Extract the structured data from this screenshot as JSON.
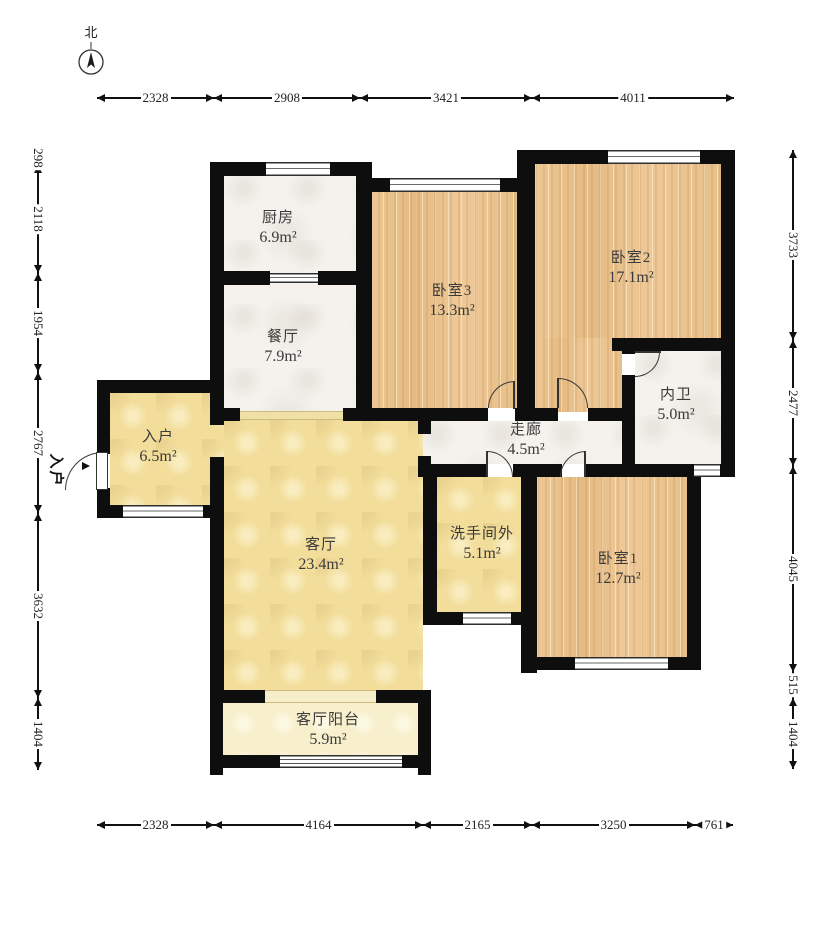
{
  "compass": {
    "label": "北"
  },
  "entry_marker": {
    "label": "入户"
  },
  "rooms": {
    "kitchen": {
      "name": "厨房",
      "area": "6.9m²"
    },
    "dining": {
      "name": "餐厅",
      "area": "7.9m²"
    },
    "bedroom3": {
      "name": "卧室3",
      "area": "13.3m²"
    },
    "bedroom2": {
      "name": "卧室2",
      "area": "17.1m²"
    },
    "inner_bath": {
      "name": "内卫",
      "area": "5.0m²"
    },
    "corridor": {
      "name": "走廊",
      "area": "4.5m²"
    },
    "entry": {
      "name": "入户",
      "area": "6.5m²"
    },
    "living": {
      "name": "客厅",
      "area": "23.4m²"
    },
    "washroom": {
      "name": "洗手间外",
      "area": "5.1m²"
    },
    "bedroom1": {
      "name": "卧室1",
      "area": "12.7m²"
    },
    "balcony": {
      "name": "客厅阳台",
      "area": "5.9m²"
    }
  },
  "dimensions": [
    {
      "name": "top",
      "dir": "h",
      "pos": 98,
      "from": 97,
      "segments": [
        {
          "to": 214,
          "label": "2328"
        },
        {
          "to": 360,
          "label": "2908"
        },
        {
          "to": 532,
          "label": "3421"
        },
        {
          "to": 734,
          "label": "4011"
        }
      ]
    },
    {
      "name": "bottom",
      "dir": "h",
      "pos": 825,
      "from": 97,
      "segments": [
        {
          "to": 214,
          "label": "2328"
        },
        {
          "to": 423,
          "label": "4164"
        },
        {
          "to": 532,
          "label": "2165"
        },
        {
          "to": 695,
          "label": "3250"
        },
        {
          "to": 733,
          "label": "761"
        }
      ]
    },
    {
      "name": "left",
      "dir": "v",
      "pos": 38,
      "from": 150,
      "segments": [
        {
          "to": 165,
          "label": "298"
        },
        {
          "to": 273,
          "label": "2118"
        },
        {
          "to": 372,
          "label": "1954"
        },
        {
          "to": 513,
          "label": "2767"
        },
        {
          "to": 698,
          "label": "3632"
        },
        {
          "to": 770,
          "label": "1404"
        }
      ]
    },
    {
      "name": "right",
      "dir": "v",
      "pos": 793,
      "from": 150,
      "segments": [
        {
          "to": 340,
          "label": "3733"
        },
        {
          "to": 466,
          "label": "2477"
        },
        {
          "to": 672,
          "label": "4045"
        },
        {
          "to": 698,
          "label": "515"
        },
        {
          "to": 769,
          "label": "1404"
        }
      ]
    }
  ],
  "colors": {
    "wall": "#0e0e0e",
    "wood": "#eac28b",
    "marble": "#f5f2ed",
    "yellow": "#f2dd9a",
    "pale_yellow": "#f8f0cd",
    "line": "#111111"
  }
}
